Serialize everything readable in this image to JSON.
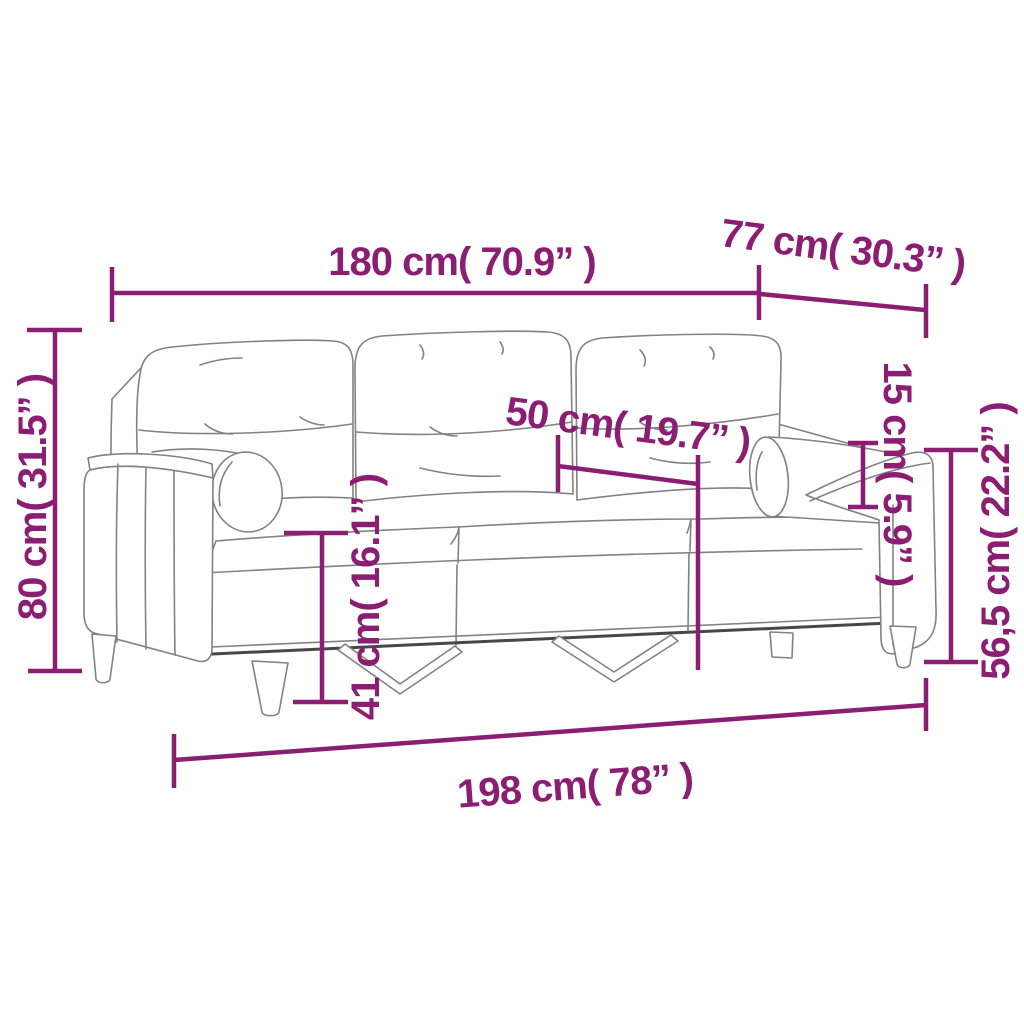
{
  "colors": {
    "dimension": "#8B1E73",
    "outline": "#828282",
    "outline_dark": "#474747",
    "background": "#ffffff"
  },
  "diagram": {
    "subject": "3-seater sofa with bolster pillows, line drawing with dimension arrows"
  },
  "measurements": {
    "seat_width": {
      "label": "180 cm( 70.9” )"
    },
    "depth": {
      "label": "77 cm( 30.3” )"
    },
    "back_height": {
      "label": "80 cm( 31.5” )"
    },
    "seat_depth": {
      "label": "50 cm( 19.7” )"
    },
    "pillow": {
      "label": "15 cm( 5.9” )"
    },
    "arm_height": {
      "label": "56,5 cm( 22.2” )"
    },
    "seat_height": {
      "label": "41 cm( 16.1” )"
    },
    "total_width": {
      "label": "198 cm( 78” )"
    }
  }
}
